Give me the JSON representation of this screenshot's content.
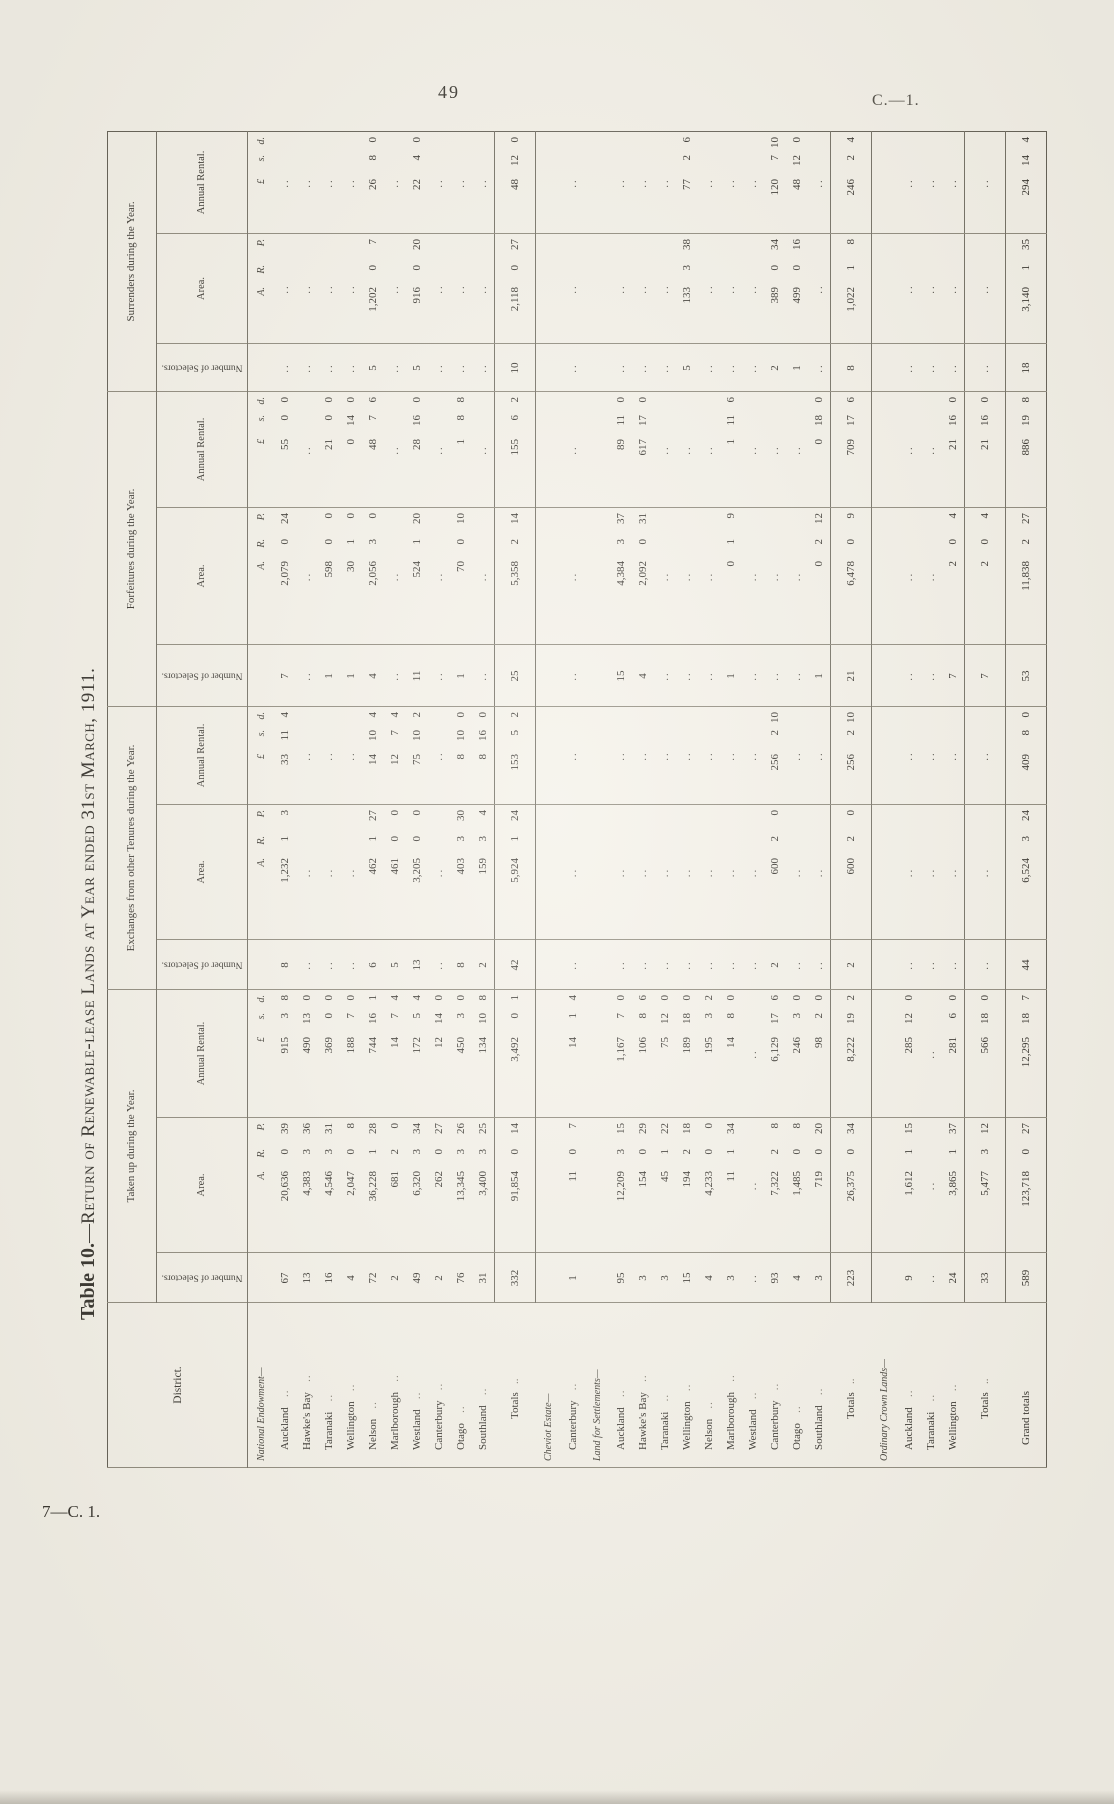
{
  "page": {
    "number": "49",
    "doc_ref": "C.—1.",
    "footer": "7—C. 1."
  },
  "title": {
    "prefix": "Table 10.",
    "separator": "—",
    "text": "Return of Renewable-lease Lands at Year ended 31st March, 1911."
  },
  "table": {
    "stub_header": "District.",
    "groups": [
      {
        "label": "Taken up during the Year."
      },
      {
        "label": "Exchanges from other Tenures during the Year."
      },
      {
        "label": "Forfeitures during the Year."
      },
      {
        "label": "Surrenders during the Year."
      }
    ],
    "sub_headers": {
      "selectors": "Number of Selectors.",
      "area": "Area.",
      "rental": "Annual Rental."
    },
    "units": {
      "area": "A.|R.|P.",
      "rental": "£|s.|d."
    },
    "rows": [
      {
        "type": "section",
        "label": "National Endowment—",
        "cells": [
          "",
          "A.|R.|P.",
          "£|s.|d.",
          "",
          "A.|R.|P.",
          "£|s.|d.",
          "",
          "A.|R.|P.",
          "£|s.|d.",
          "",
          "A.|R.|P.",
          "£|s.|d."
        ]
      },
      {
        "type": "data",
        "label": "Auckland",
        "cells": [
          "67",
          "20,636|0|39",
          "915|3|8",
          "8",
          "1,232|1|3",
          "33|11|4",
          "7",
          "2,079|0|24",
          "55|0|0",
          "..",
          "..",
          ".."
        ]
      },
      {
        "type": "data",
        "label": "Hawke's Bay",
        "cells": [
          "13",
          "4,383|3|36",
          "490|13|0",
          "..",
          "..",
          "..",
          "..",
          "..",
          "..",
          "..",
          "..",
          ".."
        ]
      },
      {
        "type": "data",
        "label": "Taranaki",
        "cells": [
          "16",
          "4,546|3|31",
          "369|0|0",
          "..",
          "..",
          "..",
          "1",
          "598|0|0",
          "21|0|0",
          "..",
          "..",
          ".."
        ]
      },
      {
        "type": "data",
        "label": "Wellington",
        "cells": [
          "4",
          "2,047|0|8",
          "188|7|0",
          "..",
          "..",
          "..",
          "1",
          "30|1|0",
          "0|14|0",
          "..",
          "..",
          ".."
        ]
      },
      {
        "type": "data",
        "label": "Nelson",
        "cells": [
          "72",
          "36,228|1|28",
          "744|16|1",
          "6",
          "462|1|27",
          "14|10|4",
          "4",
          "2,056|3|0",
          "48|7|6",
          "5",
          "1,202|0|7",
          "26|8|0"
        ]
      },
      {
        "type": "data",
        "label": "Marlborough",
        "cells": [
          "2",
          "681|2|0",
          "14|7|4",
          "5",
          "461|0|0",
          "12|7|4",
          "..",
          "..",
          "..",
          "..",
          "..",
          ".."
        ]
      },
      {
        "type": "data",
        "label": "Westland",
        "cells": [
          "49",
          "6,320|3|34",
          "172|5|4",
          "13",
          "3,205|0|0",
          "75|10|2",
          "11",
          "524|1|20",
          "28|16|0",
          "5",
          "916|0|20",
          "22|4|0"
        ]
      },
      {
        "type": "data",
        "label": "Canterbury",
        "cells": [
          "2",
          "262|0|27",
          "12|14|0",
          "..",
          "..",
          "..",
          "..",
          "..",
          "..",
          "..",
          "..",
          ".."
        ]
      },
      {
        "type": "data",
        "label": "Otago",
        "cells": [
          "76",
          "13,345|3|26",
          "450|3|0",
          "8",
          "403|3|30",
          "8|10|0",
          "1",
          "70|0|10",
          "1|8|8",
          "..",
          "..",
          ".."
        ]
      },
      {
        "type": "data",
        "label": "Southland",
        "cells": [
          "31",
          "3,400|3|25",
          "134|10|8",
          "2",
          "159|3|4",
          "8|16|0",
          "..",
          "..",
          "..",
          "..",
          "..",
          ".."
        ]
      },
      {
        "type": "total",
        "label": "Totals",
        "cells": [
          "332",
          "91,854|0|14",
          "3,492|0|1",
          "42",
          "5,924|1|24",
          "153|5|2",
          "25",
          "5,358|2|14",
          "155|6|2",
          "10",
          "2,118|0|27",
          "48|12|0"
        ]
      },
      {
        "type": "section",
        "label": "Cheviot Estate—",
        "cells": [
          "",
          "",
          "",
          "",
          "",
          "",
          "",
          "",
          "",
          "",
          "",
          ""
        ]
      },
      {
        "type": "data",
        "label": "Canterbury",
        "cells": [
          "1",
          "11|0|7",
          "14|1|4",
          "..",
          "..",
          "..",
          "..",
          "..",
          "..",
          "..",
          "..",
          ".."
        ]
      },
      {
        "type": "section",
        "label": "Land for Settlements—",
        "cells": [
          "",
          "",
          "",
          "",
          "",
          "",
          "",
          "",
          "",
          "",
          "",
          ""
        ]
      },
      {
        "type": "data",
        "label": "Auckland",
        "cells": [
          "95",
          "12,209|3|15",
          "1,167|7|0",
          "..",
          "..",
          "..",
          "15",
          "4,384|3|37",
          "89|11|0",
          "..",
          "..",
          ".."
        ]
      },
      {
        "type": "data",
        "label": "Hawke's Bay",
        "cells": [
          "3",
          "154|0|29",
          "106|8|6",
          "..",
          "..",
          "..",
          "4",
          "2,092|0|31",
          "617|17|0",
          "..",
          "..",
          ".."
        ]
      },
      {
        "type": "data",
        "label": "Taranaki",
        "cells": [
          "3",
          "45|1|22",
          "75|12|0",
          "..",
          "..",
          "..",
          "..",
          "..",
          "..",
          "..",
          "..",
          ".."
        ]
      },
      {
        "type": "data",
        "label": "Wellington",
        "cells": [
          "15",
          "194|2|18",
          "189|18|0",
          "..",
          "..",
          "..",
          "..",
          "..",
          "..",
          "5",
          "133|3|38",
          "77|2|6"
        ]
      },
      {
        "type": "data",
        "label": "Nelson",
        "cells": [
          "4",
          "4,233|0|0",
          "195|3|2",
          "..",
          "..",
          "..",
          "..",
          "..",
          "..",
          "..",
          "..",
          ".."
        ]
      },
      {
        "type": "data",
        "label": "Marlborough",
        "cells": [
          "3",
          "11|1|34",
          "14|8|0",
          "..",
          "..",
          "..",
          "1",
          "0|1|9",
          "1|11|6",
          "..",
          "..",
          ".."
        ]
      },
      {
        "type": "data",
        "label": "Westland",
        "cells": [
          "..",
          "..",
          "..",
          "..",
          "..",
          "..",
          "..",
          "..",
          "..",
          "..",
          "..",
          ".."
        ]
      },
      {
        "type": "data",
        "label": "Canterbury",
        "cells": [
          "93",
          "7,322|2|8",
          "6,129|17|6",
          "2",
          "600|2|0",
          "256|2|10",
          "..",
          "..",
          "..",
          "2",
          "389|0|34",
          "120|7|10"
        ]
      },
      {
        "type": "data",
        "label": "Otago",
        "cells": [
          "4",
          "1,485|0|8",
          "246|3|0",
          "..",
          "..",
          "..",
          "..",
          "..",
          "..",
          "1",
          "499|0|16",
          "48|12|0"
        ]
      },
      {
        "type": "data",
        "label": "Southland",
        "cells": [
          "3",
          "719|0|20",
          "98|2|0",
          "..",
          "..",
          "..",
          "1",
          "0|2|12",
          "0|18|0",
          "..",
          "..",
          ".."
        ]
      },
      {
        "type": "total",
        "label": "Totals",
        "cells": [
          "223",
          "26,375|0|34",
          "8,222|19|2",
          "2",
          "600|2|0",
          "256|2|10",
          "21",
          "6,478|0|9",
          "709|17|6",
          "8",
          "1,022|1|8",
          "246|2|4"
        ]
      },
      {
        "type": "section",
        "label": "Ordinary Crown Lands—",
        "cells": [
          "",
          "",
          "",
          "",
          "",
          "",
          "",
          "",
          "",
          "",
          "",
          ""
        ]
      },
      {
        "type": "data",
        "label": "Auckland",
        "cells": [
          "9",
          "1,612|1|15",
          "285|12|0",
          "..",
          "..",
          "..",
          "..",
          "..",
          "..",
          "..",
          "..",
          ".."
        ]
      },
      {
        "type": "data",
        "label": "Taranaki",
        "cells": [
          "..",
          "..",
          "..",
          "..",
          "..",
          "..",
          "..",
          "..",
          "..",
          "..",
          "..",
          ".."
        ]
      },
      {
        "type": "data",
        "label": "Wellington",
        "cells": [
          "24",
          "3,865|1|37",
          "281|6|0",
          "..",
          "..",
          "..",
          "7",
          "2|0|4",
          "21|16|0",
          "..",
          "..",
          ".."
        ]
      },
      {
        "type": "total",
        "label": "Totals",
        "cells": [
          "33",
          "5,477|3|12",
          "566|18|0",
          "..",
          "..",
          "..",
          "7",
          "2|0|4",
          "21|16|0",
          "..",
          "..",
          ".."
        ]
      },
      {
        "type": "grand",
        "label": "Grand totals",
        "cells": [
          "589",
          "123,718|0|27",
          "12,295|18|7",
          "44",
          "6,524|3|24",
          "409|8|0",
          "53",
          "11,838|2|27",
          "886|19|8",
          "18",
          "3,140|1|35",
          "294|14|4"
        ]
      }
    ]
  }
}
